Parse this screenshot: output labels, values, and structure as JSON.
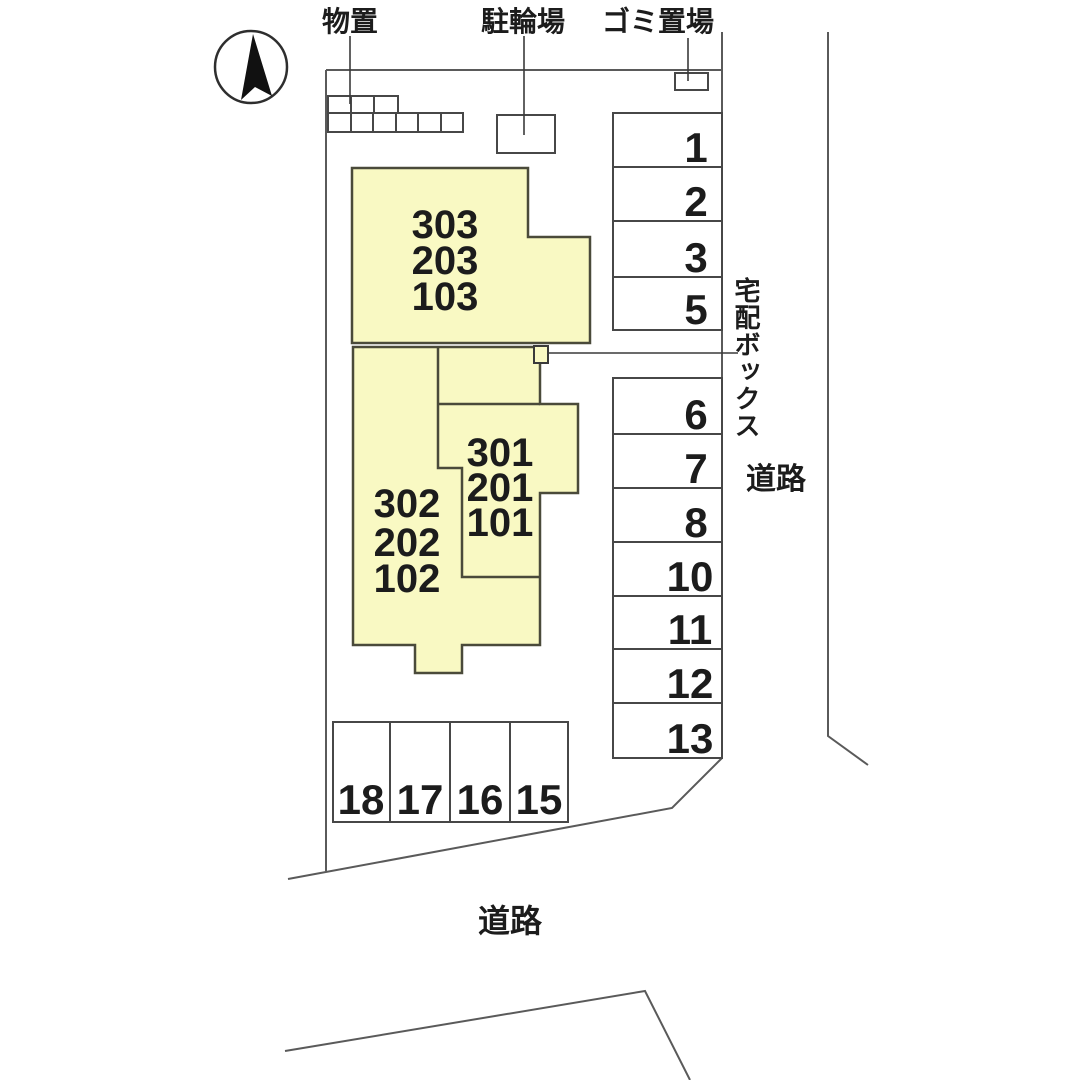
{
  "labels": {
    "storage": "物置",
    "bicycle_parking": "駐輪場",
    "garbage_area": "ゴミ置場",
    "delivery_box": "宅配ボックス",
    "road_right": "道路",
    "road_bottom": "道路"
  },
  "buildings": {
    "a": {
      "units": [
        "303",
        "203",
        "103"
      ]
    },
    "b_left": {
      "units": [
        "302",
        "202",
        "102"
      ]
    },
    "b_right": {
      "units": [
        "301",
        "201",
        "101"
      ]
    }
  },
  "parking": {
    "upper": [
      "1",
      "2",
      "3",
      "5"
    ],
    "lower": [
      "6",
      "7",
      "8",
      "10",
      "11",
      "12",
      "13"
    ],
    "bottom": [
      "18",
      "17",
      "16",
      "15"
    ]
  },
  "colors": {
    "building_fill": "#f9f9c3",
    "line": "#474747",
    "text": "#1c1c1c"
  }
}
